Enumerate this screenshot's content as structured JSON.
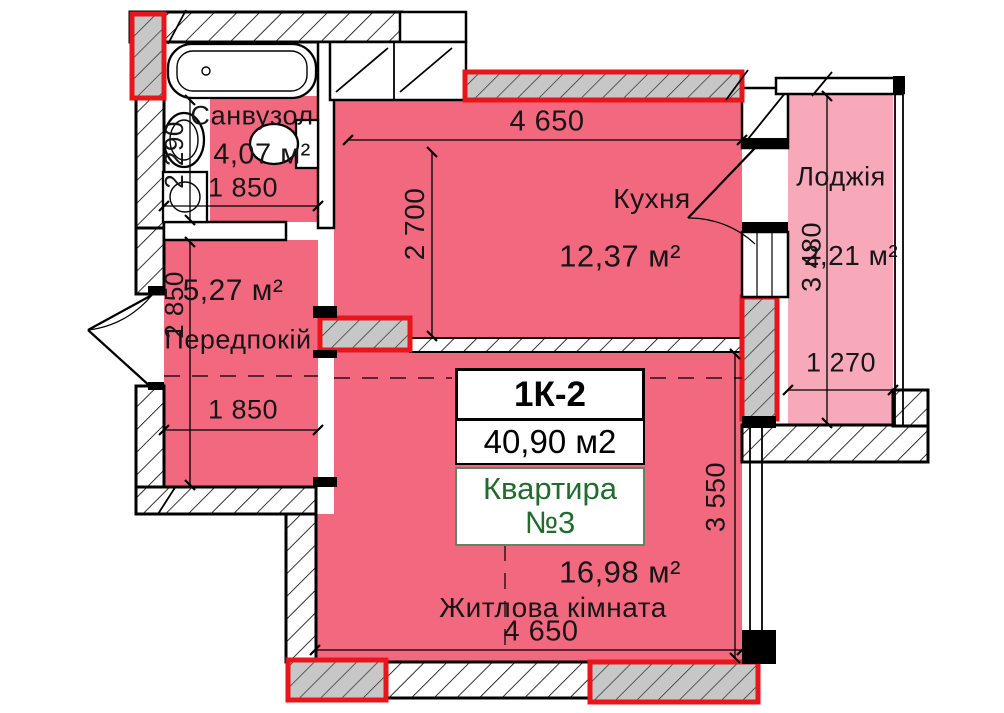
{
  "apartment_card": {
    "type_code": "1К-2",
    "total_area": "40,90 м2",
    "unit_line1": "Квартира",
    "unit_line2": "№3"
  },
  "rooms": {
    "bathroom": {
      "name": "Санвузол",
      "area": "4,07 м²"
    },
    "hallway": {
      "name": "Передпокій",
      "area": "5,27 м²"
    },
    "kitchen": {
      "name": "Кухня",
      "area": "12,37 м²"
    },
    "living_room": {
      "name": "Житлова кімната",
      "area": "16,98 м²"
    },
    "loggia": {
      "name": "Лоджія",
      "area": "2,21 м²"
    }
  },
  "dimensions": {
    "bathroom_width": "1 850",
    "bathroom_depth": "2 290",
    "hallway_width": "1 850",
    "hallway_depth": "2 850",
    "kitchen_width": "4 650",
    "kitchen_depth": "2 700",
    "living_width": "4 650",
    "living_depth": "3 550",
    "loggia_width": "1 270",
    "loggia_depth": "3 480"
  },
  "colors": {
    "room_fill": "#f2697f",
    "loggia_fill": "#f8a9b9",
    "highlight_wall_outline": "#e8151b",
    "highlight_wall_fill": "#c7c7c7",
    "unit_text_green": "#226b2e",
    "line_black": "#000000"
  }
}
